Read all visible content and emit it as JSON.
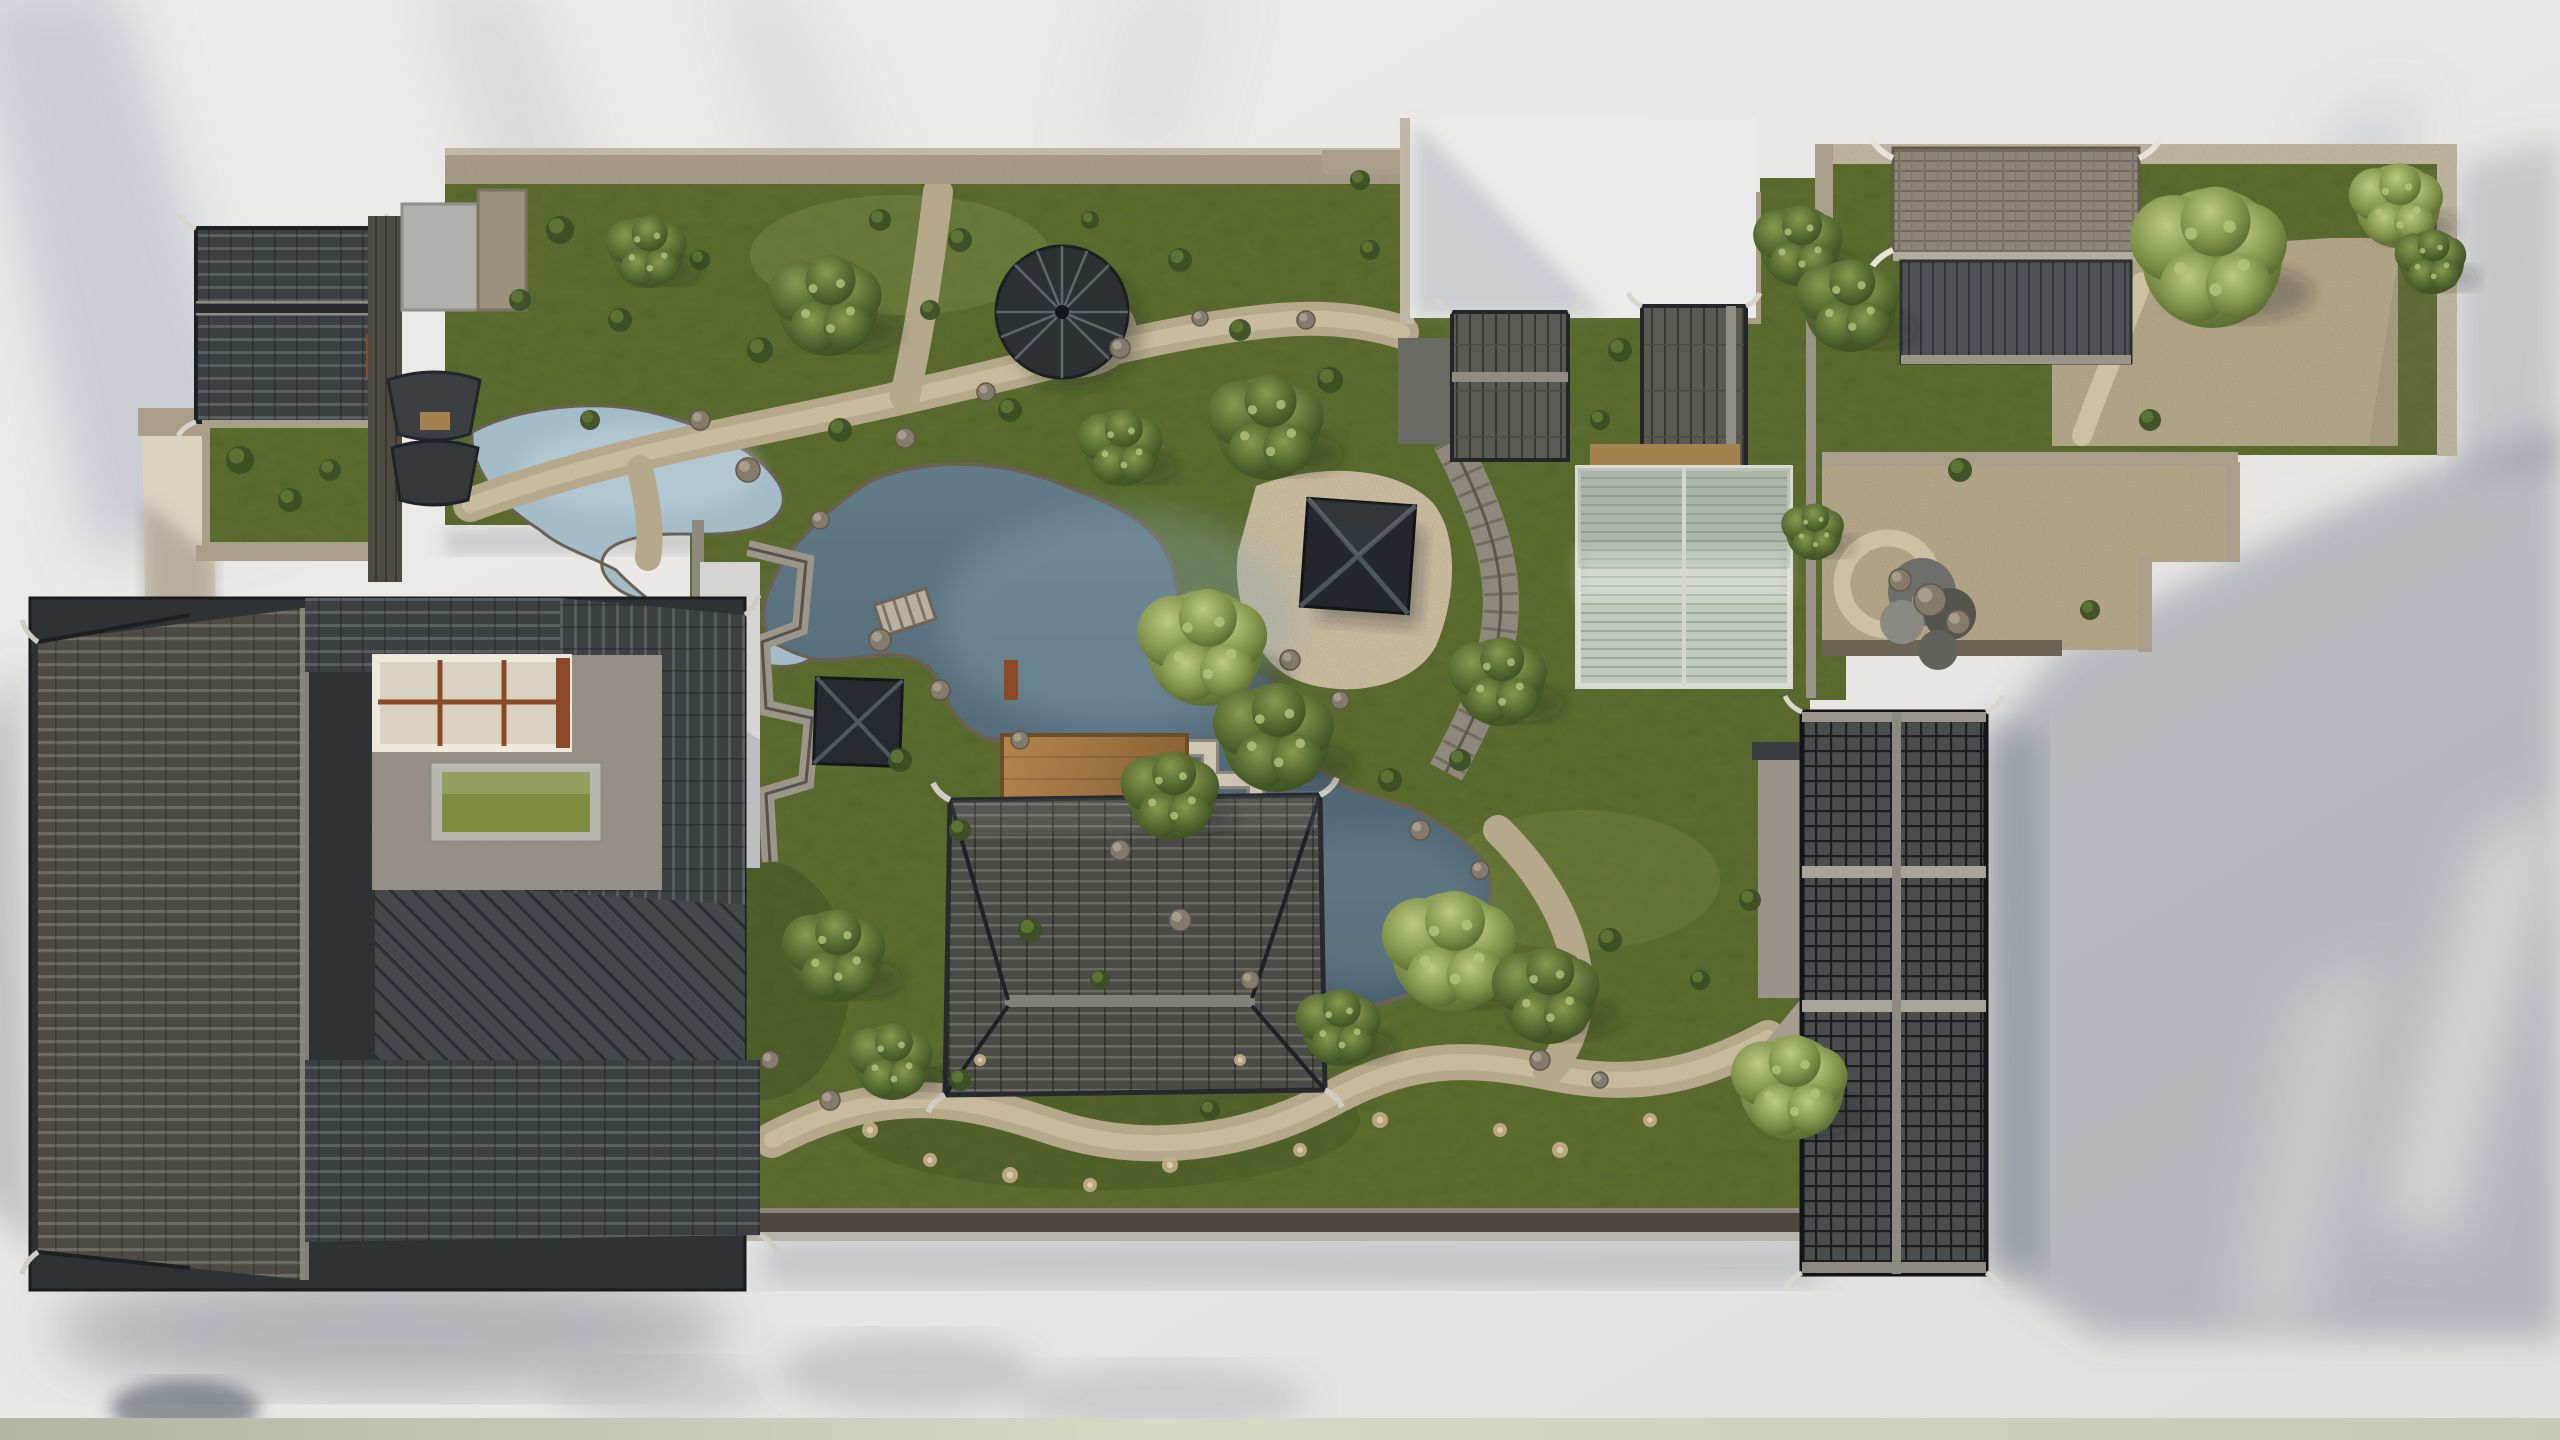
{
  "scene": {
    "title": "Aerial photograph of a miniature traditional Chinese garden model on a white table",
    "regions": [
      {
        "name": "courtyard-compound-southwest",
        "label": "Large dark-tiled courtyard house with skylight window and green table in stone courtyard"
      },
      {
        "name": "house-northwest",
        "label": "Small gabled house with dark tile roof and shrub courtyard"
      },
      {
        "name": "upper-garden",
        "label": "Walled lawn with winding gravel paths, rocks and a small pond"
      },
      {
        "name": "umbrella-pavilion",
        "label": "Ribbed umbrella-shaped pavilion canopy on the lawn"
      },
      {
        "name": "main-pond",
        "label": "Central irregular pond with rocky banks, zigzag bridge and stone bridge"
      },
      {
        "name": "square-pavilion-knoll",
        "label": "Square hip-roof pavilion on a pebble mound by the pond"
      },
      {
        "name": "square-pavilion-west",
        "label": "Small square pavilion beside zigzag garden wall"
      },
      {
        "name": "main-hall",
        "label": "Large hip-roofed hall with wooden deck platform"
      },
      {
        "name": "white-courtyard",
        "label": "Bright empty walled courtyard"
      },
      {
        "name": "gallery-buildings-middle",
        "label": "Pair of plank-roofed garden buildings with covered walkway"
      },
      {
        "name": "greenhouse",
        "label": "Barrel-vaulted translucent greenhouse"
      },
      {
        "name": "north-east-compound",
        "label": "Walled compound with brick-tiled hall, gravel court and trees"
      },
      {
        "name": "east-garden",
        "label": "Small gravel garden with circular path and rockery"
      },
      {
        "name": "east-halls",
        "label": "Long grid-tiled twin halls casting a large shadow"
      },
      {
        "name": "table-surface",
        "label": "White table surface with diagonal light streaks and leaf shadows"
      }
    ],
    "trees": [
      {
        "x": 648,
        "y": 252,
        "r": 36,
        "tone": "dark"
      },
      {
        "x": 828,
        "y": 306,
        "r": 50,
        "tone": "dark"
      },
      {
        "x": 1268,
        "y": 428,
        "r": 52,
        "tone": "dark"
      },
      {
        "x": 1122,
        "y": 448,
        "r": 38,
        "tone": "dark"
      },
      {
        "x": 1800,
        "y": 246,
        "r": 40,
        "tone": "dark"
      },
      {
        "x": 1205,
        "y": 648,
        "r": 58,
        "tone": "light"
      },
      {
        "x": 1276,
        "y": 738,
        "r": 54,
        "tone": "dark"
      },
      {
        "x": 1172,
        "y": 796,
        "r": 44,
        "tone": "dark"
      },
      {
        "x": 1500,
        "y": 682,
        "r": 44,
        "tone": "dark"
      },
      {
        "x": 1452,
        "y": 952,
        "r": 60,
        "tone": "light"
      },
      {
        "x": 1548,
        "y": 996,
        "r": 48,
        "tone": "dark"
      },
      {
        "x": 1340,
        "y": 1028,
        "r": 38,
        "tone": "dark"
      },
      {
        "x": 836,
        "y": 956,
        "r": 46,
        "tone": "dark"
      },
      {
        "x": 892,
        "y": 1062,
        "r": 38,
        "tone": "dark"
      },
      {
        "x": 2212,
        "y": 258,
        "r": 70,
        "tone": "light"
      },
      {
        "x": 1850,
        "y": 306,
        "r": 46,
        "tone": "dark"
      },
      {
        "x": 2398,
        "y": 206,
        "r": 42,
        "tone": "light"
      },
      {
        "x": 2432,
        "y": 262,
        "r": 32,
        "tone": "dark"
      },
      {
        "x": 1792,
        "y": 1088,
        "r": 52,
        "tone": "light"
      },
      {
        "x": 1814,
        "y": 532,
        "r": 28,
        "tone": "dark"
      }
    ],
    "shrubs": [
      [
        560,
        230,
        14
      ],
      [
        620,
        320,
        12
      ],
      [
        700,
        260,
        10
      ],
      [
        760,
        350,
        13
      ],
      [
        880,
        220,
        11
      ],
      [
        960,
        240,
        12
      ],
      [
        1010,
        410,
        12
      ],
      [
        930,
        310,
        10
      ],
      [
        1180,
        260,
        12
      ],
      [
        1240,
        330,
        11
      ],
      [
        1330,
        380,
        13
      ],
      [
        1370,
        250,
        10
      ],
      [
        1090,
        220,
        9
      ],
      [
        520,
        300,
        11
      ],
      [
        590,
        420,
        10
      ],
      [
        840,
        430,
        12
      ],
      [
        240,
        460,
        14
      ],
      [
        290,
        500,
        12
      ],
      [
        330,
        470,
        11
      ],
      [
        900,
        760,
        12
      ],
      [
        960,
        830,
        11
      ],
      [
        1030,
        930,
        12
      ],
      [
        1100,
        980,
        10
      ],
      [
        1390,
        780,
        12
      ],
      [
        1460,
        760,
        11
      ],
      [
        960,
        1080,
        11
      ],
      [
        1210,
        1110,
        10
      ],
      [
        1610,
        940,
        12
      ],
      [
        1700,
        980,
        10
      ],
      [
        1750,
        900,
        11
      ],
      [
        1620,
        350,
        12
      ],
      [
        1600,
        420,
        10
      ],
      [
        2090,
        610,
        10
      ],
      [
        1960,
        470,
        12
      ],
      [
        2150,
        420,
        11
      ],
      [
        1360,
        180,
        10
      ]
    ],
    "rocks": [
      [
        700,
        420,
        10
      ],
      [
        748,
        470,
        12
      ],
      [
        820,
        520,
        9
      ],
      [
        905,
        438,
        10
      ],
      [
        986,
        392,
        9
      ],
      [
        1120,
        348,
        10
      ],
      [
        1200,
        318,
        8
      ],
      [
        1306,
        320,
        9
      ],
      [
        880,
        640,
        11
      ],
      [
        940,
        690,
        10
      ],
      [
        1020,
        740,
        9
      ],
      [
        1120,
        850,
        10
      ],
      [
        1180,
        920,
        11
      ],
      [
        1250,
        980,
        9
      ],
      [
        1420,
        830,
        10
      ],
      [
        1480,
        870,
        9
      ],
      [
        1540,
        1060,
        10
      ],
      [
        1600,
        1080,
        8
      ],
      [
        830,
        1100,
        10
      ],
      [
        770,
        1060,
        9
      ],
      [
        1290,
        660,
        10
      ],
      [
        1340,
        700,
        9
      ],
      [
        1930,
        600,
        16
      ],
      [
        1958,
        622,
        12
      ],
      [
        1900,
        580,
        11
      ]
    ],
    "flowers": [
      [
        870,
        1130,
        8
      ],
      [
        930,
        1160,
        7
      ],
      [
        1010,
        1175,
        8
      ],
      [
        1090,
        1185,
        7
      ],
      [
        1170,
        1165,
        8
      ],
      [
        1300,
        1150,
        7
      ],
      [
        1380,
        1120,
        8
      ],
      [
        1500,
        1130,
        7
      ],
      [
        1560,
        1150,
        8
      ],
      [
        1650,
        1120,
        7
      ],
      [
        980,
        1060,
        6
      ],
      [
        1240,
        1060,
        6
      ]
    ]
  },
  "palette": {
    "bg_base": "#eae9e7",
    "bg_base2": "#e0e0de",
    "strip_1": "#b2b6a2",
    "strip_2": "#d7d9c7",
    "strip_3": "#c6c9b6",
    "grass_base": "#5f6e33",
    "grass_deep": "#38461d",
    "grass_lit": "#8b9855",
    "foliage_dark": "#3c4f24",
    "foliage_mid": "#5d7334",
    "foliage_light": "#93a558",
    "foliage_pale": "#b4c47e",
    "water_deep": "#475c6a",
    "water_mid": "#627b89",
    "water_light": "#8da7b4",
    "stream_light": "#a4bcc8",
    "gravel": "#b5a88b",
    "gravel_light": "#cec0a3",
    "gravel_dark": "#94876d",
    "stone_wall": "#a89e8a",
    "stone_light": "#c2b9a5",
    "stone_dark": "#6b6354",
    "court_stone": "#97928b",
    "court_white": "#ebebe9",
    "roof_black": "#2e3235",
    "roof_dark": "#3c4043",
    "roof_row": "#5d6265",
    "roof_ridge": "#918e84",
    "roof_pale": "#8d8678",
    "roof_edge": "#17191c",
    "deck_light": "#b5854f",
    "deck_dark": "#8a6134",
    "glass_base": "#c2cabe",
    "glass_rib": "#9dab9e",
    "frame_white": "#e8e4da",
    "trim_brown": "#8a4a28",
    "table_green": "#7e8e41"
  }
}
